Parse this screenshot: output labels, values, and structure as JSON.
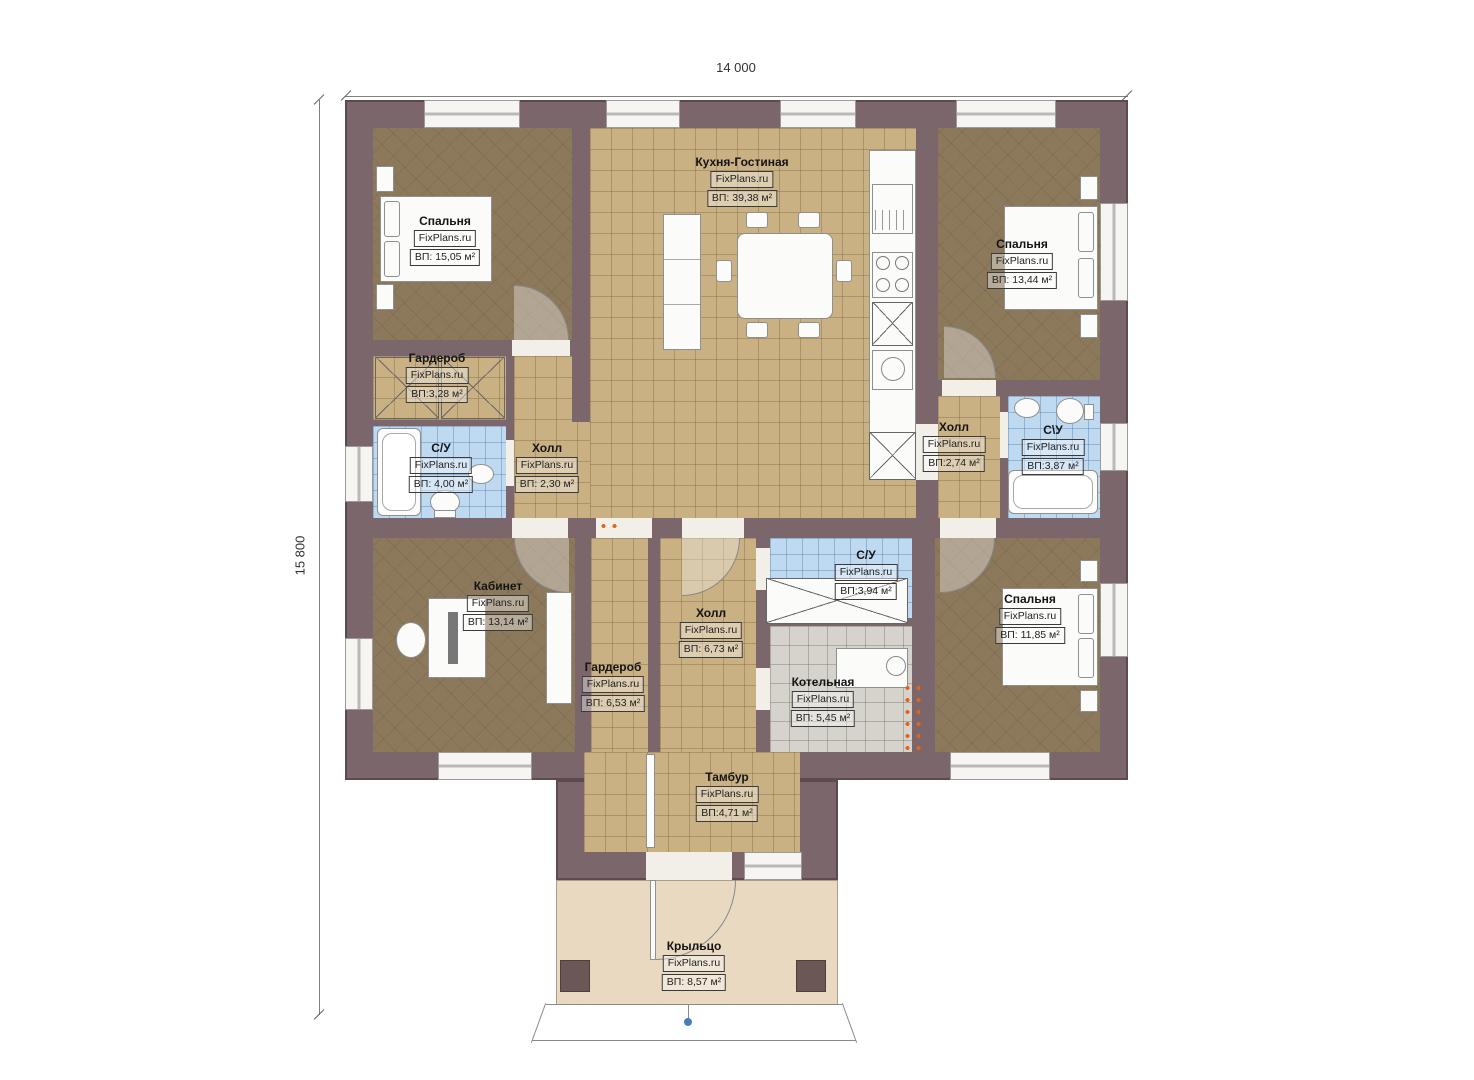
{
  "dimensions": {
    "width": "14 000",
    "height": "15 800"
  },
  "watermark": "FixPlans.ru",
  "rooms": [
    {
      "id": "bedroom-top-left",
      "name": "Спальня",
      "watermark": "FixPlans.ru",
      "area": "ВП: 15,05 м²"
    },
    {
      "id": "kitchen-living",
      "name": "Кухня-Гостиная",
      "watermark": "FixPlans.ru",
      "area": "ВП: 39,38 м²"
    },
    {
      "id": "bedroom-top-right",
      "name": "Спальня",
      "watermark": "FixPlans.ru",
      "area": "ВП: 13,44 м²"
    },
    {
      "id": "wardrobe-left",
      "name": "Гардероб",
      "watermark": "FixPlans.ru",
      "area": "ВП:3,28 м²"
    },
    {
      "id": "bathroom-left",
      "name": "С/У",
      "watermark": "FixPlans.ru",
      "area": "ВП: 4,00 м²"
    },
    {
      "id": "hall-left",
      "name": "Холл",
      "watermark": "FixPlans.ru",
      "area": "ВП: 2,30 м²"
    },
    {
      "id": "hall-right",
      "name": "Холл",
      "watermark": "FixPlans.ru",
      "area": "ВП:2,74 м²"
    },
    {
      "id": "bathroom-right",
      "name": "С\\У",
      "watermark": "FixPlans.ru",
      "area": "ВП:3,87 м²"
    },
    {
      "id": "office",
      "name": "Кабинет",
      "watermark": "FixPlans.ru",
      "area": "ВП: 13,14 м²"
    },
    {
      "id": "hall-center",
      "name": "Холл",
      "watermark": "FixPlans.ru",
      "area": "ВП: 6,73 м²"
    },
    {
      "id": "wardrobe-bottom",
      "name": "Гардероб",
      "watermark": "FixPlans.ru",
      "area": "ВП: 6,53 м²"
    },
    {
      "id": "bathroom-center",
      "name": "С/У",
      "watermark": "FixPlans.ru",
      "area": "ВП:3,94 м²"
    },
    {
      "id": "boiler-room",
      "name": "Котельная",
      "watermark": "FixPlans.ru",
      "area": "ВП: 5,45 м²"
    },
    {
      "id": "bedroom-bottom-right",
      "name": "Спальня",
      "watermark": "FixPlans.ru",
      "area": "ВП: 11,85 м²"
    },
    {
      "id": "vestibule",
      "name": "Тамбур",
      "watermark": "FixPlans.ru",
      "area": "ВП:4,71 м²"
    },
    {
      "id": "porch",
      "name": "Крыльцо",
      "watermark": "FixPlans.ru",
      "area": "ВП: 8,57 м²"
    }
  ],
  "colors": {
    "wall": "#7b666b",
    "wood_floor": "#8c795c",
    "tile_tan": "#c9b184",
    "tile_blue": "#bed9f0",
    "tile_gray": "#d6d3cc",
    "porch": "#e8d9c0",
    "radiator": "#e0661c"
  }
}
